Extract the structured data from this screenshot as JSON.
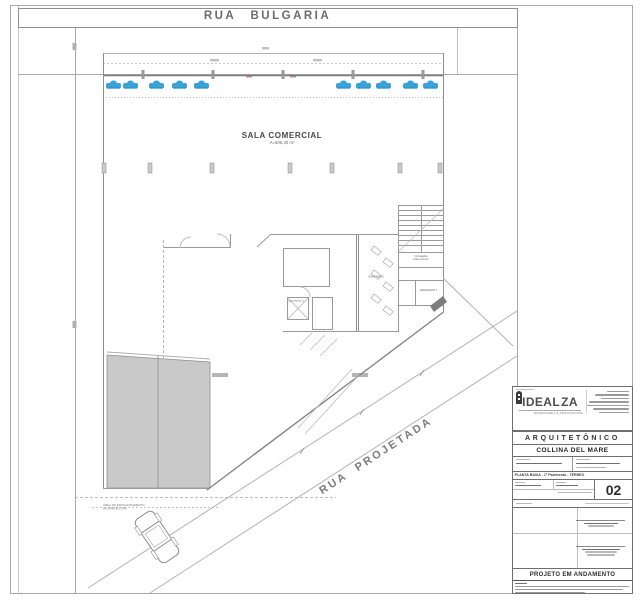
{
  "streets": {
    "top": "RUA BULGARIA",
    "diagonal": "RUA PROJETADA"
  },
  "plan": {
    "main_room": {
      "name": "SALA COMERCIAL",
      "area": "A=505,30 m²"
    },
    "labels": {
      "circulation_1": "Circulação",
      "circulation_2": "área comum",
      "elevator_right": "ELEVADOR 1",
      "elevator_left": "ELEVADOR 2",
      "sanitary": "SANITÁRIOS",
      "parking_note_1": "ÁREA DE ESTACIONAMENTO",
      "parking_note_2": "DA PREFEITURA"
    },
    "parking": {
      "car_count": 10
    }
  },
  "title_block": {
    "logo": {
      "left": "IDEAL",
      "right": "ZA",
      "subtitle": "ENGENHARIA E ARQUITETURA"
    },
    "discipline": "ARQUITETÔNICO",
    "project_name": "COLLINA DEL MARE",
    "drawing_title": "PLANTA BAIXA - 1º Pavimento - TÉRREO",
    "sheet_number": "02",
    "status_banner": "PROJETO EM ANDAMENTO"
  },
  "icons": {
    "parking_car": "car-icon",
    "street_car": "car-outline-icon",
    "logo_tower": "tower-icon"
  },
  "colors": {
    "car_blue": "#35A3E0",
    "ramp_gray": "#C9C9C9",
    "line_gray": "#9A9A9A",
    "text_gray": "#6B6B6B"
  }
}
